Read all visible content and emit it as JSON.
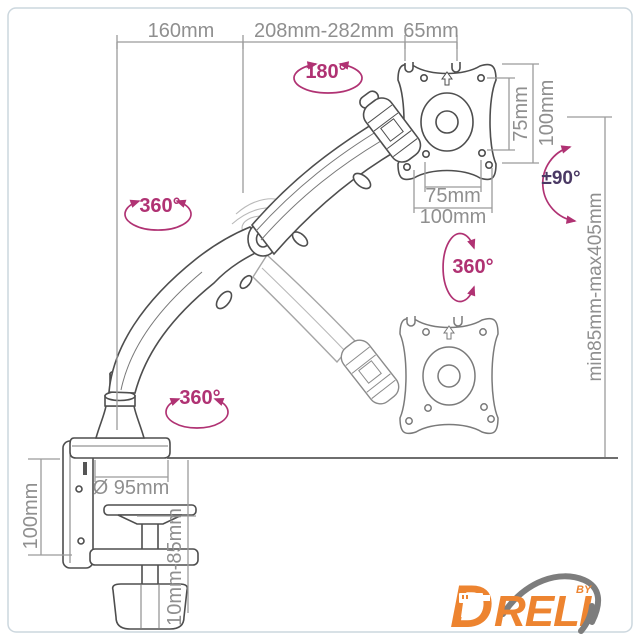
{
  "diagram": {
    "subject": "gas-spring monitor desk mount arm technical drawing",
    "dims": {
      "top_left": "160mm",
      "top_mid": "208mm-282mm",
      "top_right": "65mm",
      "vesa_v_75": "75mm",
      "vesa_v_100": "100mm",
      "vesa_h_75": "75mm",
      "vesa_h_100": "100mm",
      "height_range": "min85mm-max405mm",
      "clamp_height": "100mm",
      "base_diameter": "Ø 95mm",
      "desk_thickness": "10mm-85mm"
    },
    "angles": {
      "head_tilt": "180°",
      "elbow_swivel": "360°",
      "monitor_swivel": "360°",
      "base_swivel": "360°",
      "screen_rotation": "±90°"
    }
  },
  "logo": {
    "brand": "DRELI",
    "by": "BY"
  },
  "colors": {
    "annotation_magenta": "#b03273",
    "annotation_purple": "#4a3964",
    "dimension_gray": "#8f8f8f",
    "line_art_gray": "#4e4e4e",
    "logo_orange": "#ED8430",
    "logo_swoosh_gray": "#7d7d7d",
    "background": "#ffffff"
  }
}
